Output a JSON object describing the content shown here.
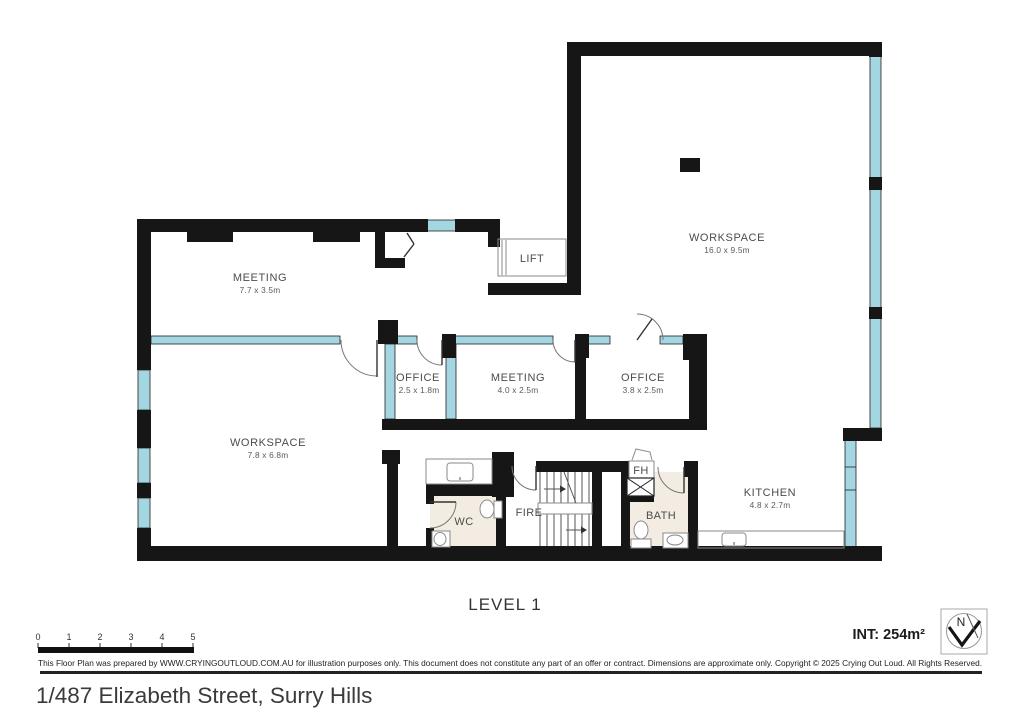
{
  "plan": {
    "level_label": "LEVEL 1",
    "area_label": "INT: 254m²",
    "compass": {
      "north_label": "N"
    },
    "scale": {
      "ticks": [
        "0",
        "1",
        "2",
        "3",
        "4",
        "5"
      ]
    },
    "rooms": {
      "workspace_main": {
        "name": "WORKSPACE",
        "dims": "16.0 x 9.5m"
      },
      "meeting_main": {
        "name": "MEETING",
        "dims": "7.7 x 3.5m"
      },
      "lift": {
        "name": "LIFT"
      },
      "office_1": {
        "name": "OFFICE",
        "dims": "2.5 x 1.8m"
      },
      "meeting_2": {
        "name": "MEETING",
        "dims": "4.0 x 2.5m"
      },
      "office_2": {
        "name": "OFFICE",
        "dims": "3.8 x 2.5m"
      },
      "workspace_2": {
        "name": "WORKSPACE",
        "dims": "7.8 x 6.8m"
      },
      "kitchen": {
        "name": "KITCHEN",
        "dims": "4.8 x 2.7m"
      },
      "wc": {
        "name": "WC"
      },
      "fire_stairs": {
        "name": "FIRE"
      },
      "fh": {
        "name": "FH"
      },
      "bath": {
        "name": "BATH"
      }
    },
    "colors": {
      "wall": "#161616",
      "glass": "#a4d6e2",
      "floor_tint": "#f3ece3"
    }
  },
  "footer": {
    "disclaimer": "This Floor Plan was prepared by WWW.CRYINGOUTLOUD.COM.AU for illustration purposes only. This document does not constitute any part of an offer or contract. Dimensions are approximate only. Copyright © 2025 Crying Out Loud. All Rights Reserved.",
    "address": "1/487 Elizabeth Street, Surry Hills"
  }
}
